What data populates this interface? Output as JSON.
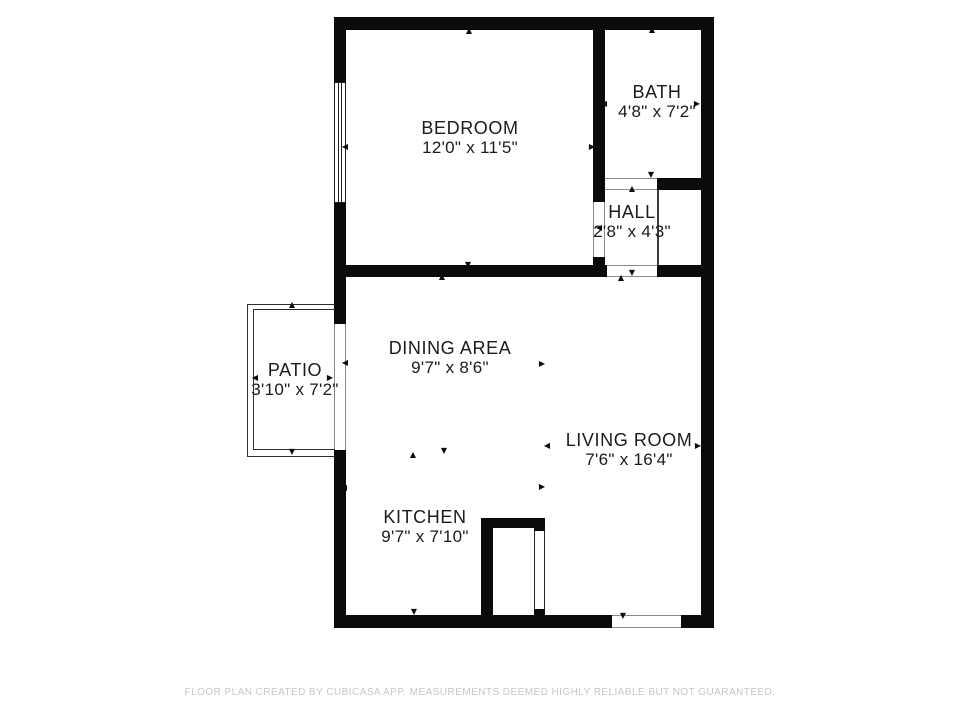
{
  "plan": {
    "rooms": [
      {
        "name": "BEDROOM",
        "dims": "12'0\" x 11'5\""
      },
      {
        "name": "BATH",
        "dims": "4'8\" x 7'2\""
      },
      {
        "name": "HALL",
        "dims": "2'8\" x 4'3\""
      },
      {
        "name": "DINING AREA",
        "dims": "9'7\" x 8'6\""
      },
      {
        "name": "LIVING ROOM",
        "dims": "7'6\" x 16'4\""
      },
      {
        "name": "KITCHEN",
        "dims": "9'7\" x 7'10\""
      },
      {
        "name": "PATIO",
        "dims": "3'10\" x 7'2\""
      }
    ],
    "colors": {
      "wall": "#0b0b0b",
      "label_text": "#1b1b1b",
      "footer_text": "#c7c7c7",
      "background": "#ffffff"
    },
    "markers": [
      {
        "x": 469,
        "y": 31,
        "dir": "up"
      },
      {
        "x": 345,
        "y": 147,
        "dir": "left"
      },
      {
        "x": 592,
        "y": 147,
        "dir": "right"
      },
      {
        "x": 468,
        "y": 265,
        "dir": "down"
      },
      {
        "x": 652,
        "y": 30,
        "dir": "up"
      },
      {
        "x": 604,
        "y": 104,
        "dir": "left"
      },
      {
        "x": 697,
        "y": 104,
        "dir": "right"
      },
      {
        "x": 651,
        "y": 175,
        "dir": "down"
      },
      {
        "x": 632,
        "y": 189,
        "dir": "up"
      },
      {
        "x": 599,
        "y": 228,
        "dir": "left"
      },
      {
        "x": 621,
        "y": 278,
        "dir": "up"
      },
      {
        "x": 632,
        "y": 273,
        "dir": "down"
      },
      {
        "x": 292,
        "y": 305,
        "dir": "up"
      },
      {
        "x": 255,
        "y": 378,
        "dir": "left"
      },
      {
        "x": 330,
        "y": 378,
        "dir": "right"
      },
      {
        "x": 292,
        "y": 452,
        "dir": "down"
      },
      {
        "x": 442,
        "y": 277,
        "dir": "up"
      },
      {
        "x": 345,
        "y": 363,
        "dir": "left"
      },
      {
        "x": 542,
        "y": 364,
        "dir": "right"
      },
      {
        "x": 444,
        "y": 451,
        "dir": "down"
      },
      {
        "x": 413,
        "y": 455,
        "dir": "up"
      },
      {
        "x": 344,
        "y": 488,
        "dir": "left"
      },
      {
        "x": 542,
        "y": 487,
        "dir": "right"
      },
      {
        "x": 414,
        "y": 612,
        "dir": "down"
      },
      {
        "x": 547,
        "y": 446,
        "dir": "left"
      },
      {
        "x": 698,
        "y": 446,
        "dir": "right"
      },
      {
        "x": 623,
        "y": 616,
        "dir": "down"
      }
    ]
  },
  "footer": {
    "text": "FLOOR PLAN CREATED BY CUBICASA APP. MEASUREMENTS DEEMED HIGHLY RELIABLE BUT NOT GUARANTEED."
  }
}
